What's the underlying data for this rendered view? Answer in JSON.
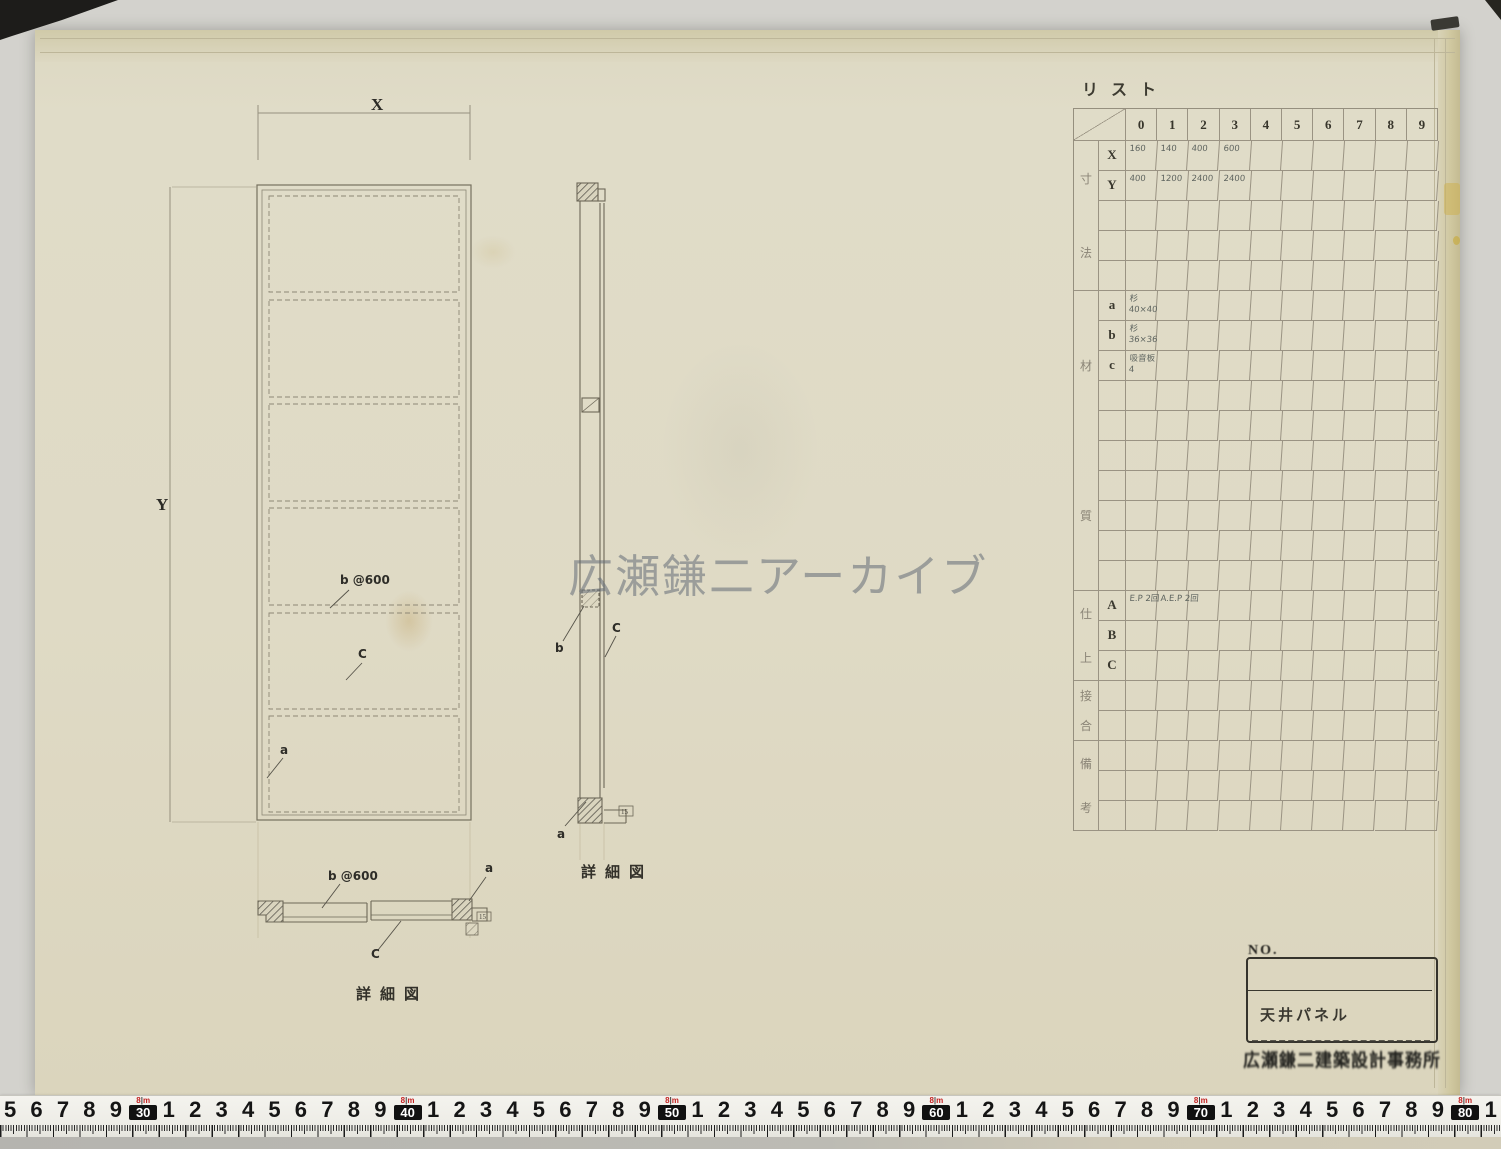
{
  "watermark": "広瀬鎌二アーカイブ",
  "list_table": {
    "title": "リスト",
    "columns": [
      "0",
      "1",
      "2",
      "3",
      "4",
      "5",
      "6",
      "7",
      "8",
      "9"
    ],
    "groups": [
      {
        "label": "寸法",
        "rows": [
          {
            "sub": "X",
            "values": [
              "160",
              "140",
              "400",
              "600"
            ]
          },
          {
            "sub": "Y",
            "values": [
              "400",
              "1200",
              "2400",
              "2400"
            ]
          },
          {},
          {},
          {}
        ]
      },
      {
        "label": "材質",
        "rows": [
          {
            "sub": "a",
            "values": [
              "杉\n40×40"
            ]
          },
          {
            "sub": "b",
            "values": [
              "杉\n36×36"
            ]
          },
          {
            "sub": "c",
            "values": [
              "吸音板\n4"
            ]
          },
          {},
          {},
          {},
          {},
          {},
          {},
          {}
        ]
      },
      {
        "label": "仕上",
        "rows": [
          {
            "sub": "A",
            "values": [
              "E.P 2回",
              "A.E.P 2回"
            ]
          },
          {
            "sub": "B",
            "values": []
          },
          {
            "sub": "C",
            "values": []
          }
        ]
      },
      {
        "label": "接合",
        "rows": [
          {},
          {}
        ]
      },
      {
        "label": "備考",
        "rows": [
          {},
          {},
          {}
        ]
      }
    ]
  },
  "drawing": {
    "dim_x": "X",
    "dim_y": "Y",
    "plan_labels": {
      "b": "b @600",
      "c": "C",
      "a": "a"
    },
    "section_labels": {
      "b": "b",
      "c": "C",
      "a": "a",
      "tag": "15",
      "caption": "詳細図"
    },
    "detail_labels": {
      "b": "b @600",
      "a": "a",
      "c": "C",
      "tag": "15",
      "caption": "詳細図"
    }
  },
  "title_block": {
    "no": "NO.",
    "title": "天井パネル",
    "stamp": "広瀬鎌二建築設計事務所"
  },
  "ruler": {
    "tag": "8m",
    "sequence": [
      "5",
      "6",
      "7",
      "8",
      "9",
      "[30]",
      "1",
      "2",
      "3",
      "4",
      "5",
      "6",
      "7",
      "8",
      "9",
      "[40]",
      "1",
      "2",
      "3",
      "4",
      "5",
      "6",
      "7",
      "8",
      "9",
      "[50]",
      "1",
      "2",
      "3",
      "4",
      "5",
      "6",
      "7",
      "8",
      "9",
      "[60]",
      "1",
      "2",
      "3",
      "4",
      "5",
      "6",
      "7",
      "8",
      "9",
      "[70]",
      "1",
      "2",
      "3",
      "4",
      "5",
      "6",
      "7",
      "8",
      "9",
      "[80]",
      "1"
    ]
  }
}
